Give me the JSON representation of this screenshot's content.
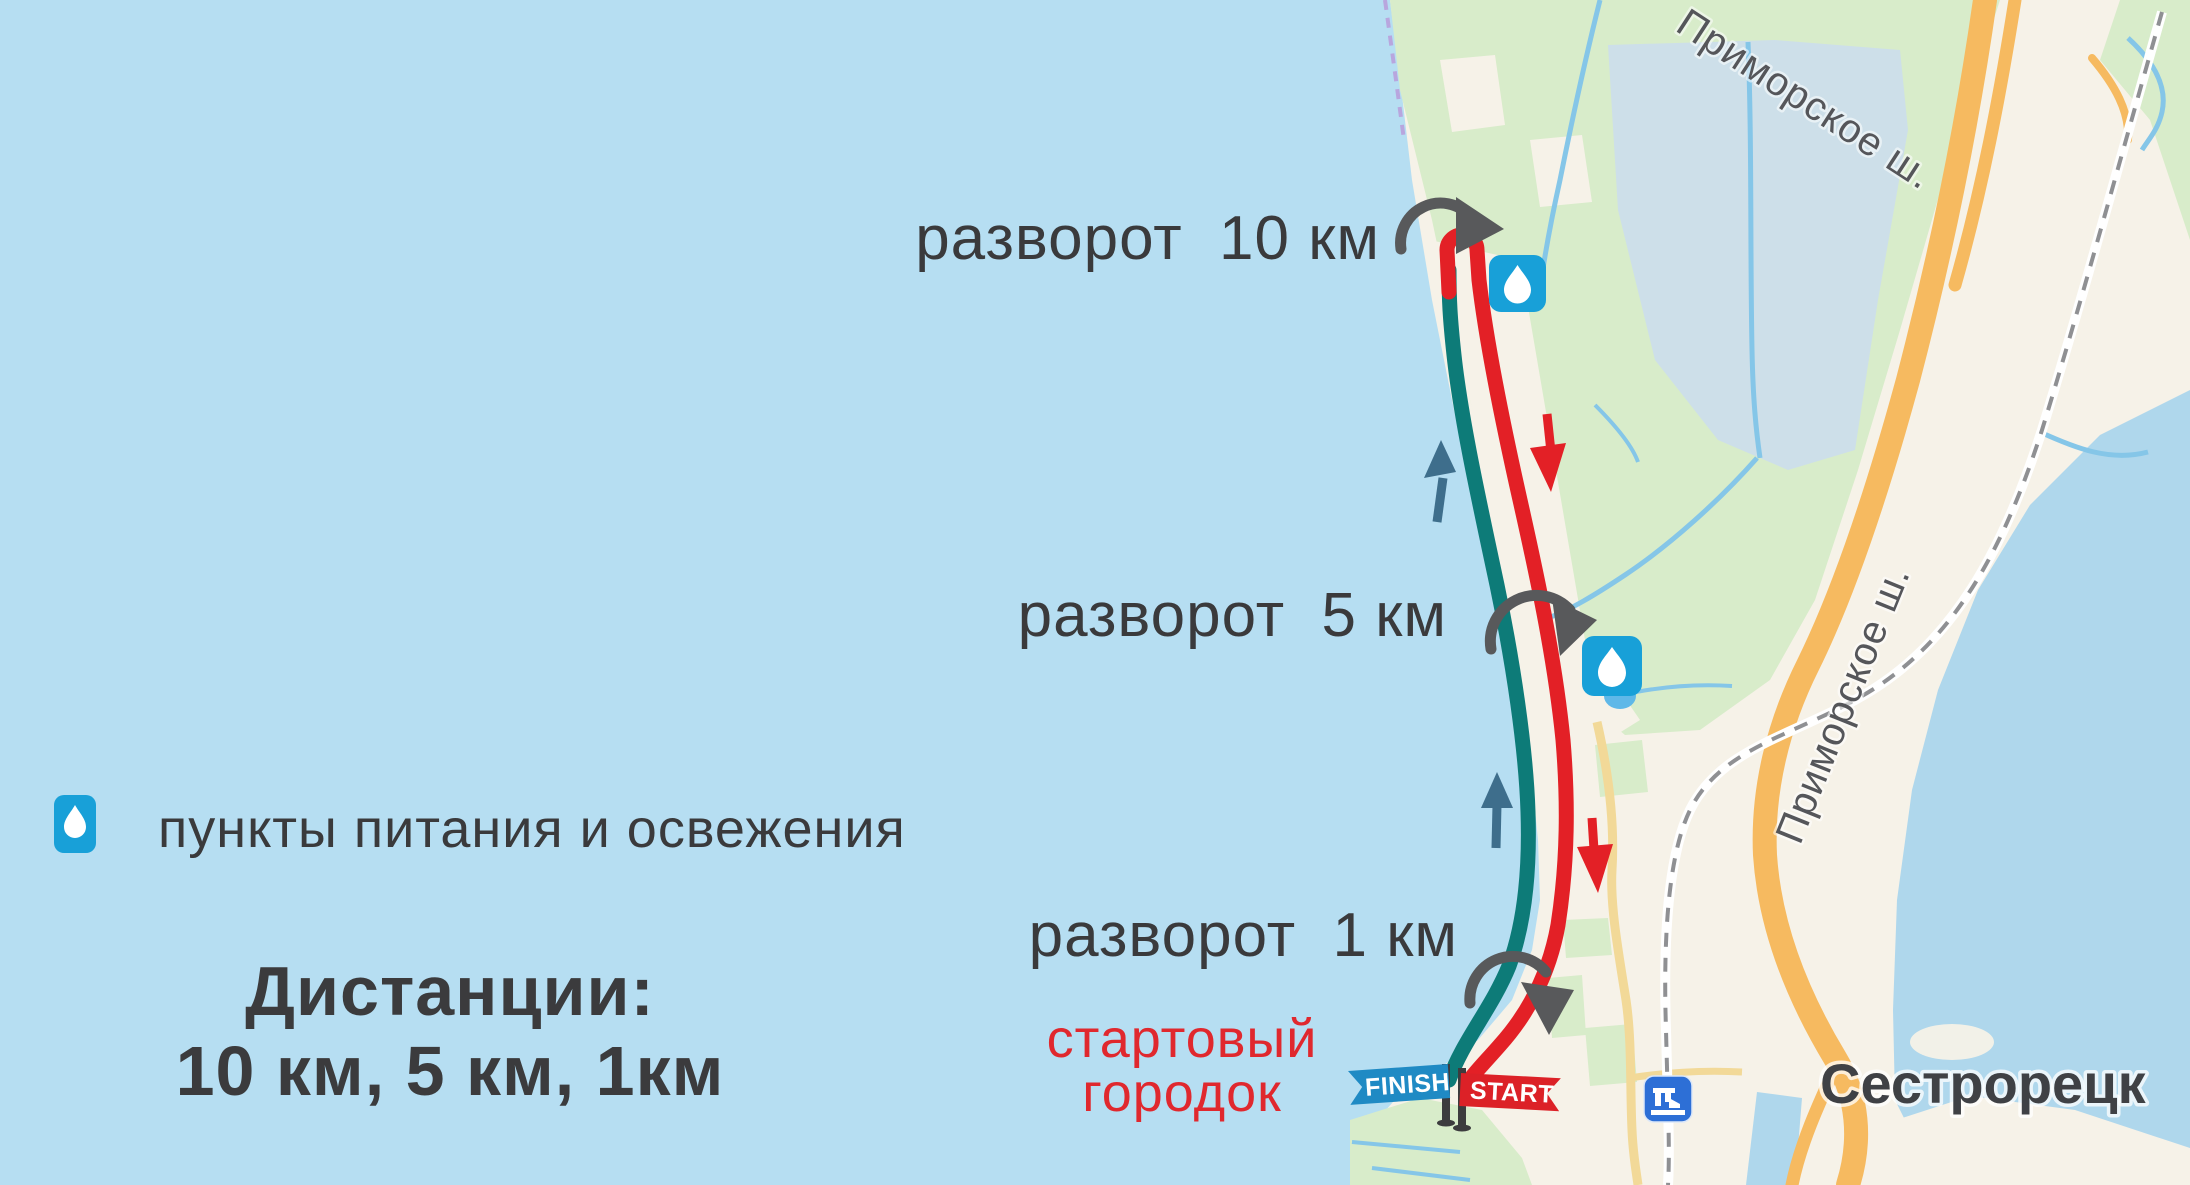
{
  "legend": {
    "icon": "water-drop-icon",
    "label": "пункты питания и освежения"
  },
  "distances_title": {
    "line1": "Дистанции:",
    "line2": "10 км, 5 км, 1км"
  },
  "turn_labels": {
    "turn_10km": "разворот  10 км",
    "turn_5km": "разворот  5 км",
    "turn_1km": "разворот  1 км"
  },
  "start_area": {
    "line1": "стартовый",
    "line2": "городок"
  },
  "banners": {
    "finish": "FINISH",
    "start": "START"
  },
  "map_labels": {
    "city": "Сестрорецк",
    "highway_top": "Приморское ш.",
    "highway_side": "Приморское ш."
  },
  "colors": {
    "sea": "#b6def2",
    "land": "#f6f2e8",
    "forest": "#d8ecca",
    "lake": "#afd7ec",
    "pond": "#cddfe9",
    "highway_orange": "#f6ba60",
    "minor_road_yellow": "#f2d998",
    "route_red": "#e32026",
    "route_teal": "#0d7b78",
    "turn_arrow_gray": "#58595b",
    "up_arrow_blue": "#3e6e8c",
    "aid_icon_blue": "#18a0d8",
    "landmark_icon_blue": "#2d6fd6",
    "finish_banner_blue": "#1f8ac4",
    "start_banner_red": "#dc2127",
    "label_dark": "#3a3a3c",
    "start_town_red": "#e0282e"
  }
}
